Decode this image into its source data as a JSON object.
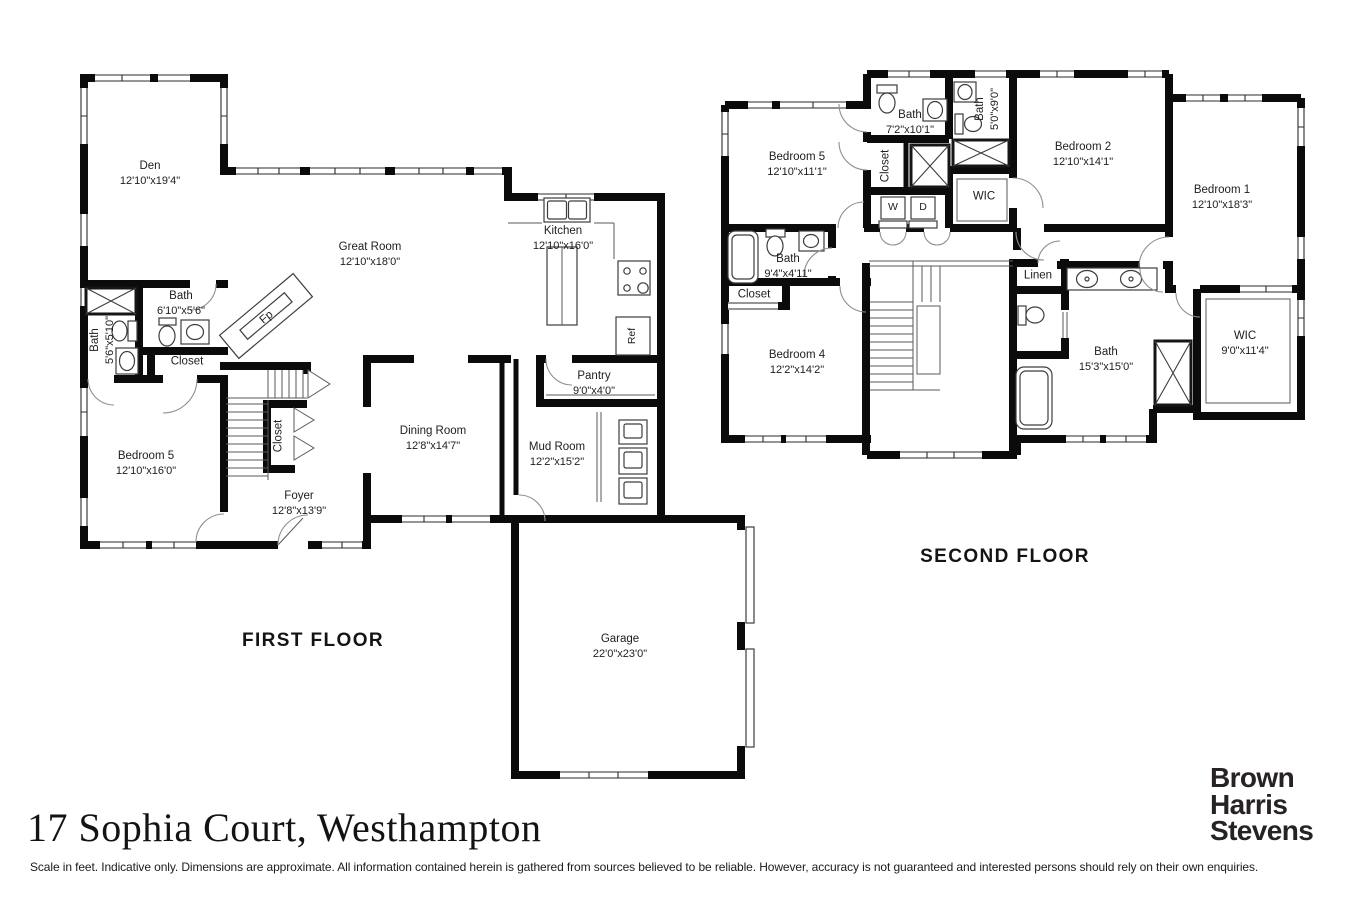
{
  "page": {
    "background": "#ffffff",
    "wall_color": "#0b0b0b"
  },
  "title": {
    "address": "17 Sophia Court, Westhampton"
  },
  "brand": {
    "line1": "Brown",
    "line2": "Harris",
    "line3": "Stevens"
  },
  "disclaimer": "Scale in feet. Indicative only. Dimensions are approximate. All information contained herein is gathered from sources believed to be reliable. However, accuracy is not guaranteed and interested persons should rely on their own enquiries.",
  "first_floor": {
    "label": "FIRST FLOOR",
    "rooms": [
      {
        "name": "Den",
        "dims": "12'10\"x19'4\""
      },
      {
        "name": "Great Room",
        "dims": "12'10\"x18'0\""
      },
      {
        "name": "Kitchen",
        "dims": "12'10\"x16'0\""
      },
      {
        "name": "Bath",
        "dims": "5'6\"x5'10\""
      },
      {
        "name": "Bath",
        "dims": "6'10\"x5'6\""
      },
      {
        "name": "Closet",
        "dims": ""
      },
      {
        "name": "Bedroom 5",
        "dims": "12'10\"x16'0\""
      },
      {
        "name": "Closet",
        "dims": ""
      },
      {
        "name": "Foyer",
        "dims": "12'8\"x13'9\""
      },
      {
        "name": "Dining Room",
        "dims": "12'8\"x14'7\""
      },
      {
        "name": "Pantry",
        "dims": "9'0\"x4'0\""
      },
      {
        "name": "Mud Room",
        "dims": "12'2\"x15'2\""
      },
      {
        "name": "Garage",
        "dims": "22'0\"x23'0\""
      }
    ],
    "fixtures": {
      "fireplace": "Fp",
      "fridge": "Ref"
    }
  },
  "second_floor": {
    "label": "SECOND FLOOR",
    "rooms": [
      {
        "name": "Bedroom 5",
        "dims": "12'10\"x11'1\""
      },
      {
        "name": "Bath",
        "dims": "7'2\"x10'1\""
      },
      {
        "name": "Bath",
        "dims": "5'0\"x9'0\""
      },
      {
        "name": "Closet",
        "dims": ""
      },
      {
        "name": "WIC",
        "dims": ""
      },
      {
        "name": "Bedroom 2",
        "dims": "12'10\"x14'1\""
      },
      {
        "name": "Bedroom 1",
        "dims": "12'10\"x18'3\""
      },
      {
        "name": "Bath",
        "dims": "9'4\"x4'11\""
      },
      {
        "name": "Closet",
        "dims": ""
      },
      {
        "name": "Bedroom 4",
        "dims": "12'2\"x14'2\""
      },
      {
        "name": "Linen",
        "dims": ""
      },
      {
        "name": "Bath",
        "dims": "15'3\"x15'0\""
      },
      {
        "name": "WIC",
        "dims": "9'0\"x11'4\""
      }
    ],
    "appliances": {
      "washer": "W",
      "dryer": "D"
    }
  }
}
